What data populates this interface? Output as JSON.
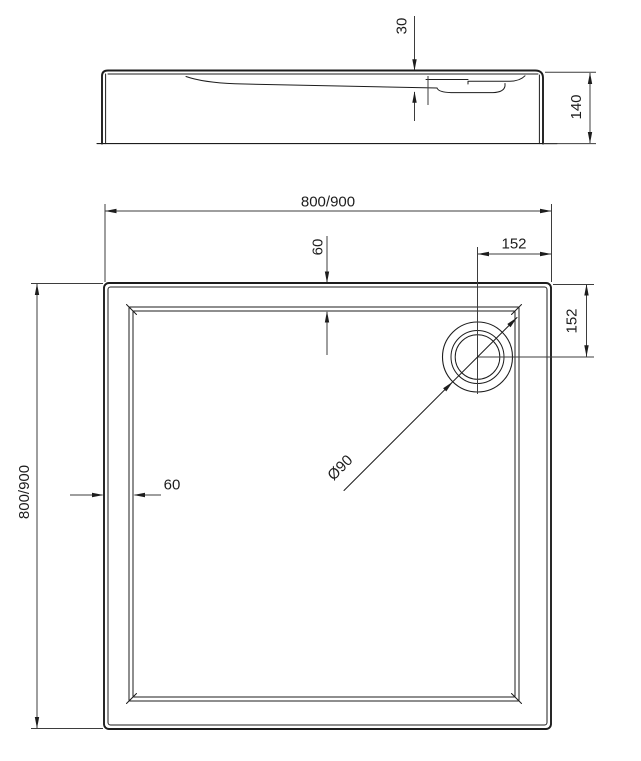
{
  "drawing": {
    "type": "technical-drawing",
    "subject": "square shower tray - side profile and plan view",
    "colors": {
      "line": "#1d1d1d",
      "dimension": "#3d3d3d",
      "background": "#ffffff"
    },
    "side_view": {
      "dims": {
        "basin_depth": "30",
        "total_height": "140"
      }
    },
    "plan_view": {
      "dims": {
        "overall_width": "800/900",
        "overall_height": "800/900",
        "rim_width_top": "60",
        "rim_width_left": "60",
        "drain_offset_horizontal": "152",
        "drain_offset_vertical": "152",
        "drain_diameter": "Ø90"
      }
    }
  }
}
